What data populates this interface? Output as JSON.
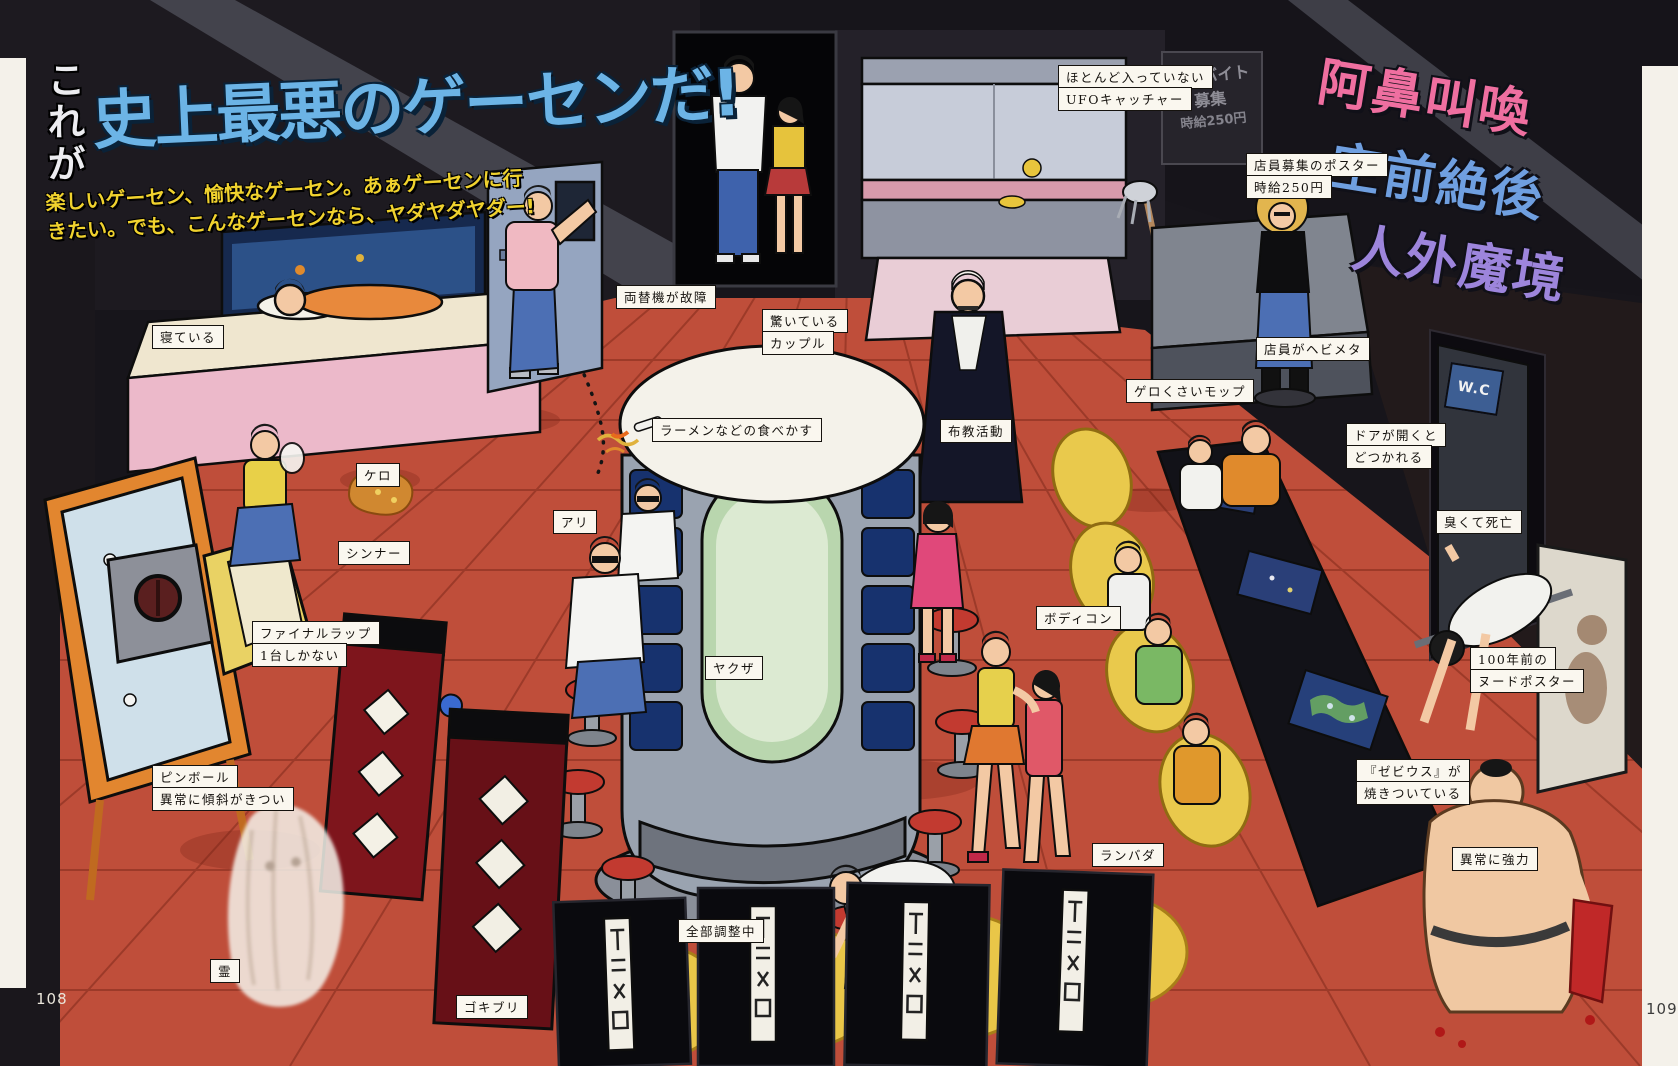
{
  "page": {
    "left_number": "108",
    "right_number": "109"
  },
  "title": {
    "kicker": "これが",
    "main": "史上最悪のゲーセンだ!",
    "subtitle_line1": "楽しいゲーセン、愉快なゲーセン。あぁゲーセンに行",
    "subtitle_line2": "きたい。でも、こんなゲーセンなら、ヤダヤダヤダー!"
  },
  "headlines": [
    {
      "text": "阿鼻叫喚",
      "color": "#ef6fa0",
      "x": 1318,
      "y": 56
    },
    {
      "text": "空前絶後",
      "color": "#6f9fe0",
      "x": 1330,
      "y": 140
    },
    {
      "text": "人外魔境",
      "color": "#9d85dc",
      "x": 1352,
      "y": 222
    }
  ],
  "wall_poster": {
    "line1": "アルバイト",
    "line2": "募集",
    "line3": "時給250円"
  },
  "wc_sign": "W.C",
  "captions": [
    {
      "id": "sleeping",
      "x": 152,
      "y": 326,
      "lines": [
        "寝ている"
      ]
    },
    {
      "id": "money-changer",
      "x": 616,
      "y": 286,
      "lines": [
        "両替機が故障"
      ]
    },
    {
      "id": "surprised-couple",
      "x": 762,
      "y": 310,
      "lines": [
        "驚いている",
        "カップル"
      ]
    },
    {
      "id": "ufo-catcher",
      "x": 1058,
      "y": 66,
      "lines": [
        "ほとんど入っていない",
        "UFOキャッチャー"
      ]
    },
    {
      "id": "staff-poster",
      "x": 1246,
      "y": 154,
      "lines": [
        "店員募集のポスター",
        "時給250円"
      ]
    },
    {
      "id": "metal-clerk",
      "x": 1256,
      "y": 338,
      "lines": [
        "店員がヘビメタ"
      ]
    },
    {
      "id": "vomit-mop",
      "x": 1126,
      "y": 380,
      "lines": [
        "ゲロくさいモップ"
      ]
    },
    {
      "id": "door-hits",
      "x": 1346,
      "y": 424,
      "lines": [
        "ドアが開くと",
        "どつかれる"
      ]
    },
    {
      "id": "smell-death",
      "x": 1436,
      "y": 511,
      "lines": [
        "臭くて死亡"
      ]
    },
    {
      "id": "nude-poster",
      "x": 1470,
      "y": 648,
      "lines": [
        "100年前の",
        "ヌードポスター"
      ]
    },
    {
      "id": "ramen-scraps",
      "x": 652,
      "y": 419,
      "lines": [
        "ラーメンなどの食べかす"
      ]
    },
    {
      "id": "missionary",
      "x": 940,
      "y": 420,
      "lines": [
        "布教活動"
      ]
    },
    {
      "id": "vomit",
      "x": 356,
      "y": 464,
      "lines": [
        "ケロ"
      ]
    },
    {
      "id": "ants",
      "x": 553,
      "y": 511,
      "lines": [
        "アリ"
      ]
    },
    {
      "id": "thinner",
      "x": 338,
      "y": 542,
      "lines": [
        "シンナー"
      ]
    },
    {
      "id": "final-lap",
      "x": 252,
      "y": 622,
      "lines": [
        "ファイナルラップ",
        "1台しかない"
      ]
    },
    {
      "id": "yakuza",
      "x": 705,
      "y": 657,
      "lines": [
        "ヤクザ"
      ]
    },
    {
      "id": "bodycon",
      "x": 1036,
      "y": 607,
      "lines": [
        "ボディコン"
      ]
    },
    {
      "id": "pinball",
      "x": 152,
      "y": 766,
      "lines": [
        "ピンボール",
        "異常に傾斜がきつい"
      ]
    },
    {
      "id": "xevious",
      "x": 1356,
      "y": 760,
      "lines": [
        "『ゼビウス』が",
        "焼きついている"
      ]
    },
    {
      "id": "lambada",
      "x": 1092,
      "y": 844,
      "lines": [
        "ランバダ"
      ]
    },
    {
      "id": "very-strong",
      "x": 1452,
      "y": 848,
      "lines": [
        "異常に強力"
      ]
    },
    {
      "id": "ghost",
      "x": 210,
      "y": 960,
      "lines": [
        "霊"
      ]
    },
    {
      "id": "cockroach",
      "x": 456,
      "y": 996,
      "lines": [
        "ゴキブリ"
      ]
    },
    {
      "id": "all-adjusting",
      "x": 678,
      "y": 920,
      "lines": [
        "全部調整中"
      ]
    }
  ],
  "colors": {
    "floor": "#bf4e3a",
    "title_blue": "#6cb4e6",
    "subtitle_yellow": "#f0d22e",
    "headline_pink": "#ef6fa0",
    "headline_blue": "#6f9fe0",
    "headline_purple": "#9d85dc"
  }
}
